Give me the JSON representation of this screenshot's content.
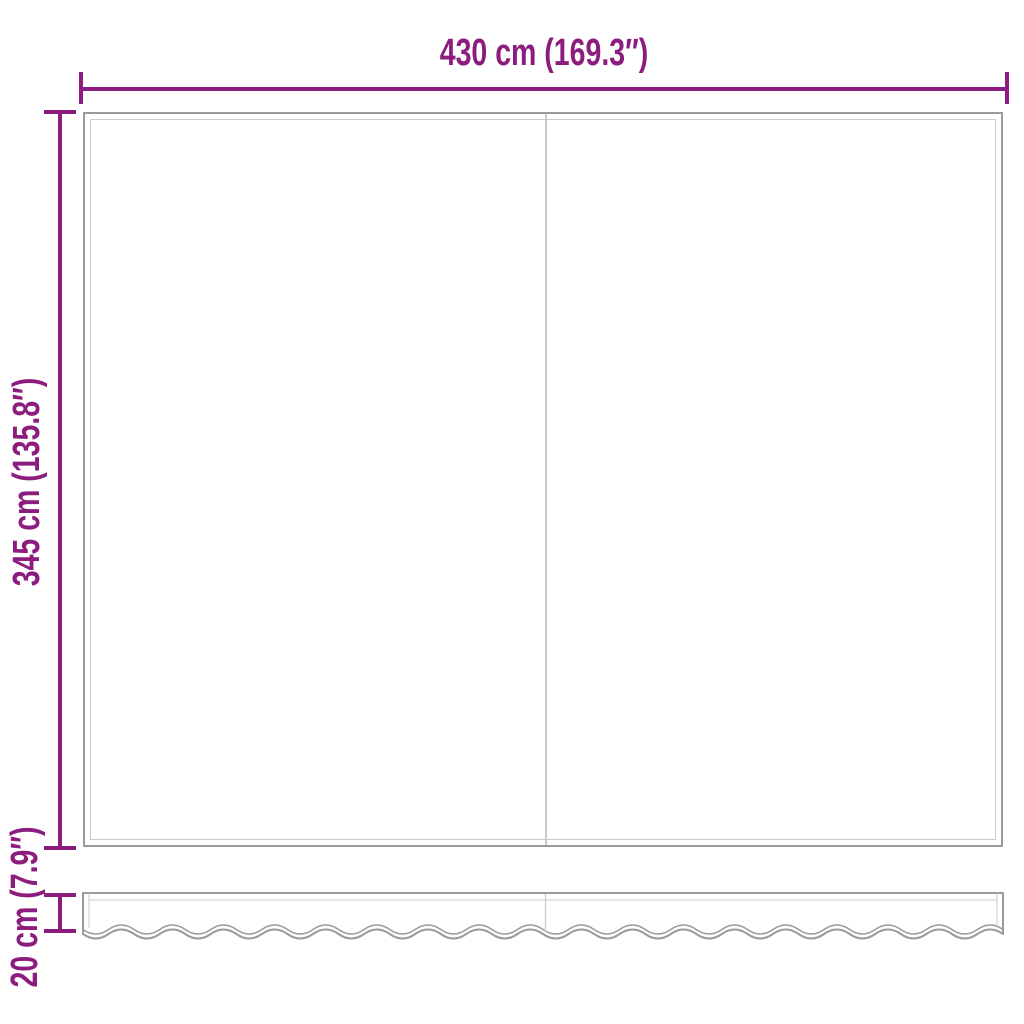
{
  "diagram": {
    "width_dimension": {
      "label": "430 cm (169.3″)"
    },
    "height_dimension": {
      "label": "345 cm (135.8″)"
    },
    "valance_dimension": {
      "label": "20 cm (7.9″)"
    }
  },
  "colors": {
    "dimension_accent": "#8C1D7E",
    "panel_outline": "#9A9A9A",
    "panel_inner_line": "#C9C9C9",
    "background": "#FFFFFF"
  }
}
